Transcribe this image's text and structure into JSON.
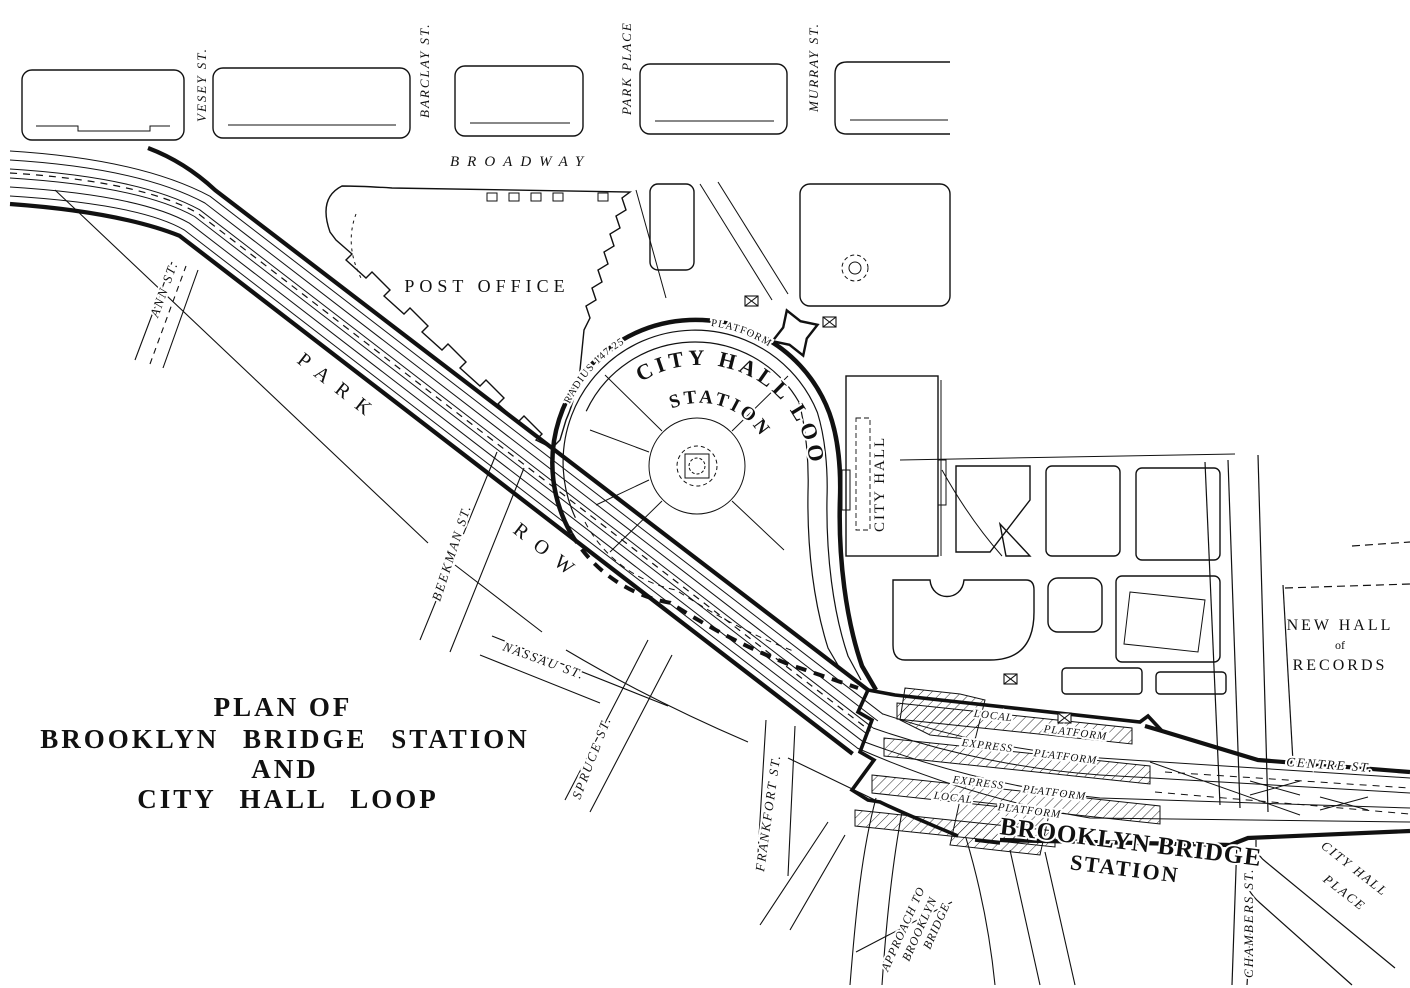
{
  "map": {
    "title": {
      "line1": "PLAN OF",
      "line2": "BROOKLYN BRIDGE STATION",
      "line3": "AND",
      "line4": "CITY HALL LOOP"
    },
    "streets": {
      "vesey": "VESEY ST.",
      "barclay": "BARCLAY ST.",
      "park_place": "PARK PLACE",
      "murray": "MURRAY ST.",
      "broadway": "BROADWAY",
      "ann": "ANN ST.",
      "park": "PARK",
      "row": "ROW",
      "beekman": "BEEKMAN ST.",
      "nassau": "NASSAU ST.",
      "spruce": "SPRUCE ST.",
      "frankfort": "FRANKFORT ST.",
      "centre": "CENTRE ST.",
      "chambers": "CHAMBERS ST.",
      "city_hall_place_line1": "CITY HALL",
      "city_hall_place_line2": "PLACE",
      "approach_line1": "APPROACH TO",
      "approach_line2": "BROOKLYN",
      "approach_line3": "BRIDGE"
    },
    "landmarks": {
      "post_office": "POST OFFICE",
      "city_hall": "CITY HALL",
      "new_hall_line1": "NEW HALL",
      "new_hall_line2": "of",
      "new_hall_line3": "RECORDS"
    },
    "loop_station": {
      "name_arc": "CITY HALL LOOP",
      "name_arc2": "STATION",
      "platform": "PLATFORM",
      "radius_note": "RADIUS 147.25"
    },
    "bridge_station": {
      "name_line1": "BROOKLYN BRIDGE",
      "name_line2": "STATION",
      "platforms": [
        {
          "w1": "LOCAL",
          "w2": "PLATFORM"
        },
        {
          "w1": "EXPRESS",
          "w2": "PLATFORM"
        },
        {
          "w1": "EXPRESS",
          "w2": "PLATFORM"
        },
        {
          "w1": "LOCAL",
          "w2": "PLATFORM"
        }
      ]
    },
    "colors": {
      "ink": "#111111",
      "paper": "#ffffff"
    }
  }
}
